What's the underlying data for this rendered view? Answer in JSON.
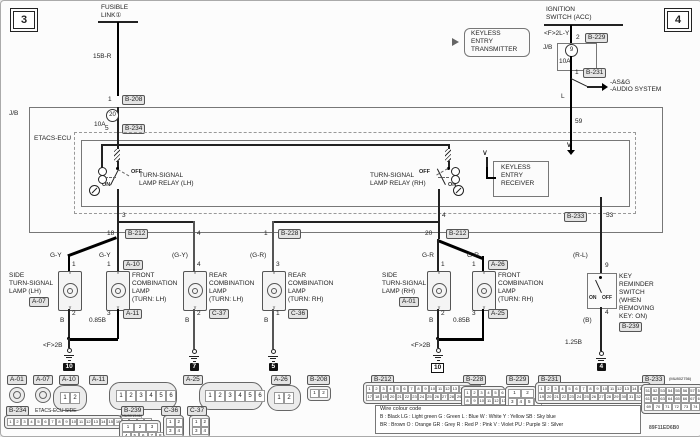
{
  "page": {
    "num_left": "3",
    "num_right": "4",
    "doc_code": "89F11ED6B0"
  },
  "fusible": {
    "l1": "FUSIBLE",
    "l2": "LINK①",
    "wire": "15B-R",
    "pin": "1",
    "conn": "B-208"
  },
  "jb": {
    "label": "J/B",
    "fuse_no": "20",
    "fuse_amp": "10A",
    "out_pin": "5",
    "out_conn": "B-234"
  },
  "ign": {
    "l1": "IGNITION",
    "l2": "SWITCH (ACC)",
    "wire1": "<F>2L-Y",
    "pin_in": "2",
    "conn_in": "B-229",
    "jb": "J/B",
    "fuse_no": "9",
    "fuse_amp": "10A",
    "pin_out": "1",
    "conn_out": "B-231",
    "br1": "-AS&G",
    "br2": "-AUDIO SYSTEM",
    "wire2": "L",
    "ecu_pin": "59"
  },
  "tx": {
    "l1": "KEYLESS",
    "l2": "ENTRY",
    "l3": "TRANSMITTER"
  },
  "ecu": {
    "label": "ETACS-ECU",
    "rly_lh": {
      "l1": "TURN-SIGNAL",
      "l2": "LAMP RELAY (LH)",
      "off": "OFF",
      "on": "ON",
      "pin": "3"
    },
    "rly_rh": {
      "l1": "TURN-SIGNAL",
      "l2": "LAMP RELAY (RH)",
      "off": "OFF",
      "on": "ON",
      "pin": "4"
    },
    "rcv": {
      "l1": "KEYLESS",
      "l2": "ENTRY",
      "l3": "RECEIVER"
    },
    "out_conn": "B-233",
    "out_pin": "53"
  },
  "bus": {
    "lh_pin": "18",
    "lh_conn": "B-212",
    "rear_lh_pin": "4",
    "rear_rh_pin": "1",
    "rear_rh_conn": "B-228",
    "rh_pin": "20",
    "rh_conn": "B-212"
  },
  "lamps": {
    "side_lh": {
      "l1": "SIDE",
      "l2": "TURN-SIGNAL",
      "l3": "LAMP (LH)",
      "conn": "A-07",
      "pin_top": "1",
      "pin_bot": "2",
      "wire_top": "G-Y",
      "wire_bot": "B"
    },
    "front_lh": {
      "l1": "FRONT",
      "l2": "COMBINATION",
      "l3": "LAMP",
      "l4": "(TURN: LH)",
      "pin_top": "1",
      "conn_top": "A-10",
      "pin_bot": "3",
      "conn_bot": "A-11",
      "wire_top": "G-Y",
      "wire_bot": "0.85B"
    },
    "rear_lh": {
      "l1": "REAR",
      "l2": "COMBINATION",
      "l3": "LAMP",
      "l4": "(TURN: LH)",
      "pin_top": "4",
      "pin_bot": "2",
      "conn_bot": "C-37",
      "wire_top": "(G-Y)",
      "wire_bot": "B"
    },
    "rear_rh": {
      "l1": "REAR",
      "l2": "COMBINATION",
      "l3": "LAMP",
      "l4": "(TURN: RH)",
      "pin_top": "3",
      "pin_bot": "1",
      "conn_bot": "C-36",
      "wire_top": "(G-R)",
      "wire_bot": "B"
    },
    "side_rh": {
      "l1": "SIDE",
      "l2": "TURN-SIGNAL",
      "l3": "LAMP (RH)",
      "conn": "A-01",
      "pin_top": "1",
      "pin_bot": "2",
      "wire_top": "G-R",
      "wire_bot": "B"
    },
    "front_rh": {
      "l1": "FRONT",
      "l2": "COMBINATION",
      "l3": "LAMP",
      "l4": "(TURN: RH)",
      "pin_top": "1",
      "conn_top": "A-26",
      "pin_bot": "3",
      "conn_bot": "A-25",
      "wire_top": "G-R",
      "wire_bot": "0.85B"
    }
  },
  "junction": {
    "left": "<F>2B",
    "right": "<F>2B"
  },
  "gnd": {
    "left": "10",
    "rear_lh": "7",
    "rear_rh": "5",
    "right": "10",
    "key": "4"
  },
  "keysw": {
    "wire_top": "(R-L)",
    "pin_top": "9",
    "on": "ON",
    "off": "OFF",
    "pin_bot": "4",
    "wire_b": "(B)",
    "wire_bot": "1.25B",
    "l1": "KEY",
    "l2": "REMINDER",
    "l3": "SWITCH",
    "l4": "(WHEN",
    "l5": "REMOVING",
    "l6": "KEY: ON)",
    "conn": "B-239"
  },
  "strip": {
    "a01": "A-01",
    "a07": "A-07",
    "a10": "A-10",
    "a11": "A-11",
    "a25": "A-25",
    "a26": "A-26",
    "b208": "B-208",
    "b212": "B-212",
    "b228": "B-228",
    "b229": "B-229",
    "b231": "B-231",
    "b233": "B-233",
    "b234": "B-234",
    "b239": "B-239",
    "c36": "C-36",
    "c37": "C-37",
    "b234_note": "ETACS-ECU SIDE",
    "b239_code": "(MU801546)",
    "b233_code": "(MU802756)",
    "pins": {
      "a10": [
        [
          "1",
          "2"
        ]
      ],
      "a11": [
        [
          "1",
          "2",
          "3",
          "4",
          "5",
          "6"
        ]
      ],
      "a25": [
        [
          "1",
          "2",
          "3",
          "4",
          "5",
          "6"
        ]
      ],
      "a26": [
        [
          "1",
          "2"
        ]
      ],
      "b208": [
        [
          "1",
          "2"
        ]
      ],
      "b212": [
        [
          "1",
          "2",
          "3",
          "4",
          "5",
          "6",
          "7",
          "8",
          "9",
          "10",
          "11",
          "12",
          "13",
          "14",
          "15",
          "16"
        ],
        [
          "17",
          "18",
          "19",
          "20",
          "21",
          "22",
          "23",
          "24",
          "25",
          "26",
          "27",
          "28",
          "29",
          "30",
          "31",
          "32"
        ]
      ],
      "b228": [
        [
          "1",
          "2",
          "3",
          "4",
          "5",
          "6",
          "7"
        ],
        [
          "8",
          "9",
          "10",
          "11",
          "12",
          "13",
          "14",
          "15",
          "16"
        ]
      ],
      "b229": [
        [
          "1",
          "2"
        ],
        [
          "3",
          "4",
          "5",
          "6"
        ]
      ],
      "b231": [
        [
          "1",
          "2",
          "3",
          "4",
          "5",
          "6",
          "7",
          "8",
          "9",
          "10",
          "11",
          "12",
          "13",
          "14",
          "15",
          "16",
          "17",
          "18"
        ],
        [
          "19",
          "20",
          "21",
          "22",
          "23",
          "24",
          "25",
          "26",
          "27",
          "28",
          "29",
          "30",
          "31",
          "32",
          "33",
          "34",
          "35",
          "36"
        ]
      ],
      "b233": [
        [
          "51",
          "52",
          "53",
          "54",
          "55",
          "56",
          "57",
          "58",
          "59",
          "60"
        ],
        [
          "61",
          "62",
          "63",
          "64",
          "65",
          "66",
          "67",
          "68"
        ],
        [
          "69",
          "70",
          "71",
          "72",
          "73",
          "74"
        ]
      ],
      "b234": [
        [
          "1",
          "2",
          "3",
          "4",
          "5",
          "6",
          "7",
          "8",
          "9",
          "10",
          "11",
          "12",
          "13",
          "14",
          "15",
          "16",
          "17",
          "18",
          "19",
          "20"
        ]
      ],
      "b239": [
        [
          "1",
          "2",
          "3"
        ],
        [
          "4",
          "5",
          "6",
          "7",
          "8",
          "9"
        ]
      ],
      "c36": [
        [
          "1",
          "2"
        ],
        [
          "3",
          "4"
        ]
      ],
      "c37": [
        [
          "1",
          "2"
        ],
        [
          "3",
          "4"
        ]
      ]
    }
  },
  "colour": {
    "title": "Wire colour code",
    "line1": "B : Black   LG : Light green   G : Green   L : Blue   W : White   Y : Yellow   SB : Sky blue",
    "line2": "BR : Brown   O : Orange   GR : Grey   R : Red   P : Pink   V : Violet   PU : Purple   SI : Silver"
  }
}
